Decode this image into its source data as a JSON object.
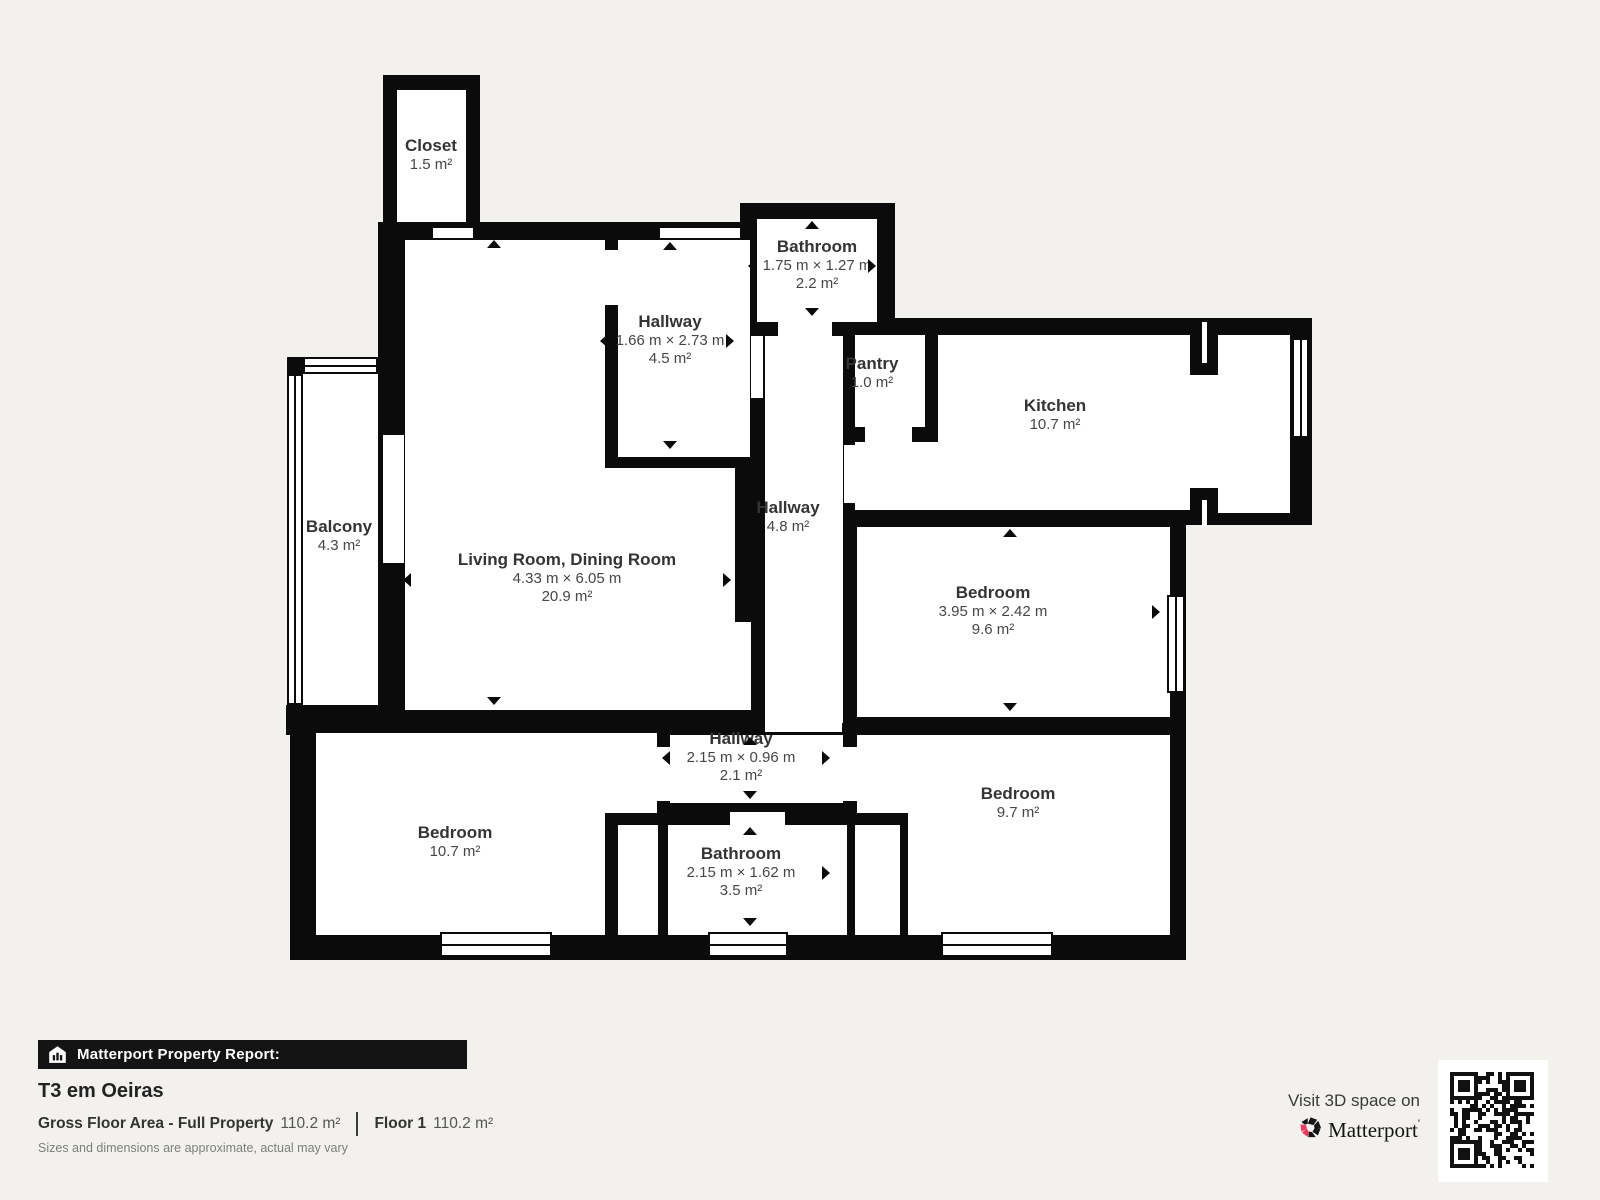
{
  "plan": {
    "rooms": [
      {
        "name": "Closet",
        "area": "1.5 m²"
      },
      {
        "name": "Bathroom",
        "dims": "1.75 m × 1.27 m",
        "area": "2.2 m²"
      },
      {
        "name": "Hallway",
        "dims": "1.66 m × 2.73 m",
        "area": "4.5 m²"
      },
      {
        "name": "Pantry",
        "area": "1.0 m²"
      },
      {
        "name": "Kitchen",
        "area": "10.7 m²"
      },
      {
        "name": "Balcony",
        "area": "4.3 m²"
      },
      {
        "name": "Living Room, Dining Room",
        "dims": "4.33 m × 6.05 m",
        "area": "20.9 m²"
      },
      {
        "name": "Hallway",
        "area": "4.8 m²"
      },
      {
        "name": "Bedroom",
        "dims": "3.95 m × 2.42 m",
        "area": "9.6 m²"
      },
      {
        "name": "Hallway",
        "dims": "2.15 m × 0.96 m",
        "area": "2.1 m²"
      },
      {
        "name": "Bedroom",
        "area": "10.7 m²"
      },
      {
        "name": "Bathroom",
        "dims": "2.15 m × 1.62 m",
        "area": "3.5 m²"
      },
      {
        "name": "Bedroom",
        "area": "9.7 m²"
      }
    ]
  },
  "footer": {
    "report_label": "Matterport Property Report:",
    "property_title": "T3 em Oeiras",
    "gfa_label": "Gross Floor Area - Full Property",
    "gfa_value": "110.2 m²",
    "floor_label": "Floor 1",
    "floor_value": "110.2 m²",
    "disclaimer": "Sizes and dimensions are approximate, actual may vary",
    "visit_text": "Visit 3D space on",
    "brand": "Matterport",
    "brand_mark": "'"
  },
  "colors": {
    "wall": "#0b0b0b",
    "background": "#f2f1ee",
    "room_fill": "#ffffff",
    "brand_pink": "#f43a5d"
  }
}
